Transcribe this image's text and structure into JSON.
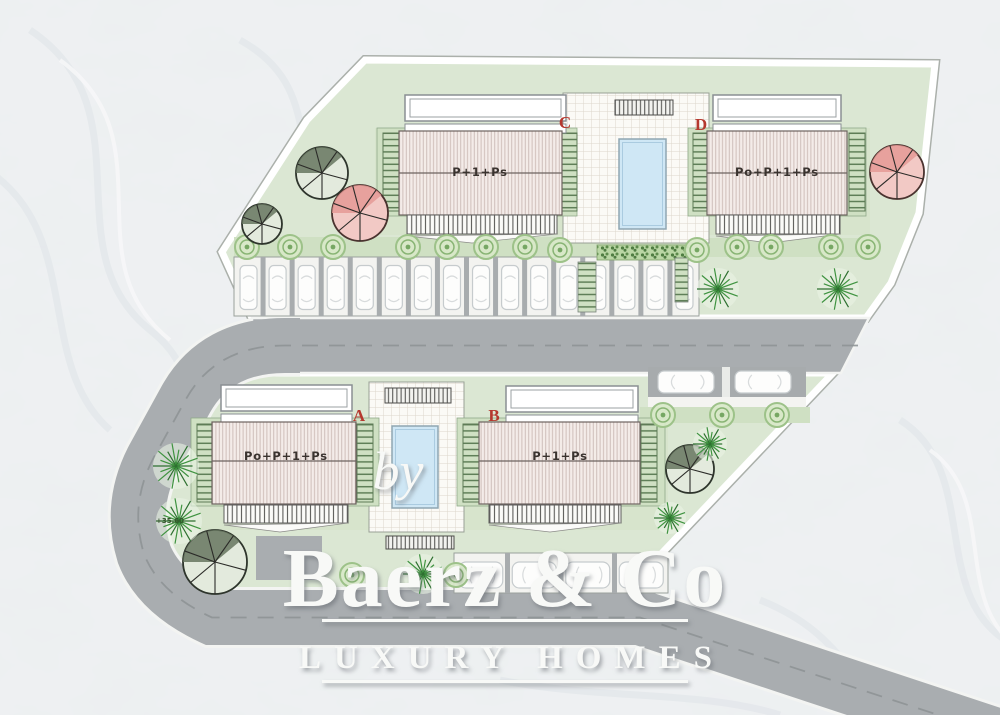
{
  "plan": {
    "buildings": [
      {
        "letter": "A",
        "floors": "Po+P+1+Ps"
      },
      {
        "letter": "B",
        "floors": "P+1+Ps"
      },
      {
        "letter": "C",
        "floors": "P+1+Ps"
      },
      {
        "letter": "D",
        "floors": "Po+P+1+Ps"
      }
    ],
    "elevation_marker": "+35.60",
    "letter_color": "#b5382e"
  },
  "watermark": {
    "prefix": "by",
    "brand": "Baerz & Co",
    "tagline": "LUXURY HOMES"
  },
  "colors": {
    "site_green": "#dbe7d3",
    "garden_green": "#cfe0c3",
    "road_gray": "#a9adb0",
    "pool_blue": "#cfe7f5",
    "roof_pink": "#f4ece9",
    "roof_stripe": "#cbb9b4",
    "tree_pink": "#f2c9c5",
    "palm_green": "#3f9340",
    "marble": "#eff1f2",
    "watermark_white": "#f8f9f7"
  }
}
